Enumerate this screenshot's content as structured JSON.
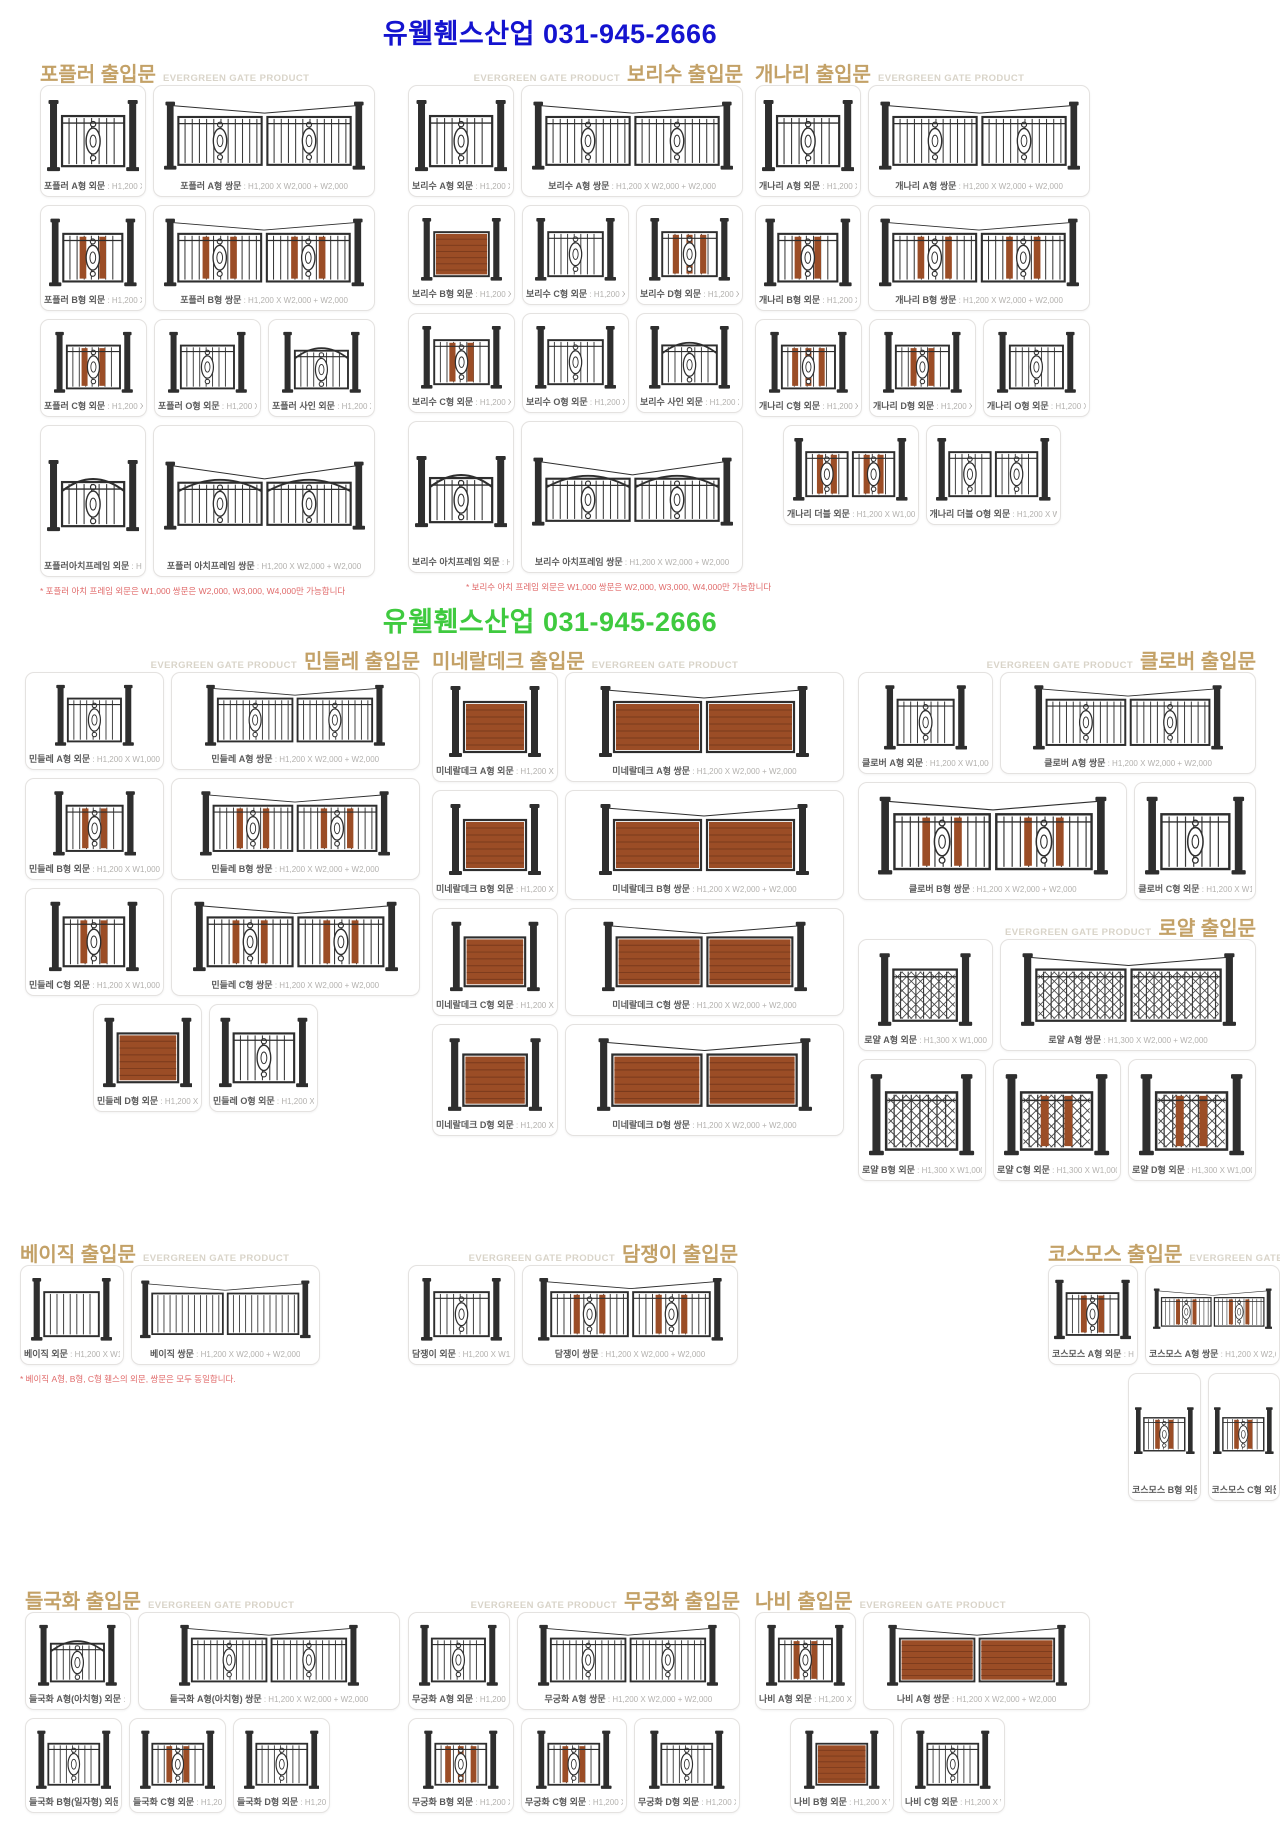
{
  "banners": {
    "top": {
      "text": "유웰휀스산업 031-945-2666",
      "color": "#1413cf"
    },
    "middle": {
      "text": "유웰휀스산업 031-945-2666",
      "color": "#3fca3f"
    }
  },
  "brand_tag": "EVERGREEN GATE PRODUCT",
  "colors": {
    "accent": "#c3a167",
    "egp_tag": "#d9d4c9",
    "wood": "#9b4d26",
    "iron": "#2e2e2e",
    "footnote": "#e06a6a"
  },
  "sections": [
    {
      "id": "poplar",
      "title": "포플러 출입문",
      "rows": [
        [
          {
            "label": "포플러 A형 외문",
            "size": "H1,200 X W1,000",
            "gate": {
              "l": 1
            }
          },
          {
            "label": "포플러 A형 쌍문",
            "size": "H1,200 X W2,000 + W2,000",
            "gate": {
              "l": 2,
              "cable": true
            }
          }
        ],
        [
          {
            "label": "포플러 B형 외문",
            "size": "H1,200 X W1,000",
            "gate": {
              "l": 1,
              "wood": 2
            }
          },
          {
            "label": "포플러 B형 쌍문",
            "size": "H1,200 X W2,000 + W2,000",
            "gate": {
              "l": 2,
              "wood": 2,
              "cable": true
            }
          }
        ],
        [
          {
            "label": "포플러 C형 외문",
            "size": "H1,200 X W1,000",
            "gate": {
              "l": 1,
              "wood": 2
            }
          },
          {
            "label": "포플러 O형 외문",
            "size": "H1,200 X W1,000",
            "gate": {
              "l": 1
            }
          },
          {
            "label": "포플러 사인 외문",
            "size": "H1,200 X W1,000",
            "gate": {
              "l": 1,
              "arch": true
            }
          }
        ],
        [
          {
            "label": "포플러아치프레임 외문",
            "size": "H1,200 X W1,000",
            "gate": {
              "l": 1,
              "arch": true
            }
          },
          {
            "label": "포플러 아치프레임 쌍문",
            "size": "H1,200 X W2,000 + W2,000",
            "gate": {
              "l": 2,
              "arch": true,
              "cable": true
            }
          }
        ]
      ],
      "footnote": "* 포플러 아치 프레임 외문은 W1,000 쌍문은 W2,000, W3,000, W4,000만 가능합니다"
    },
    {
      "id": "bodhi",
      "title": "보리수 출입문",
      "rows": [
        [
          {
            "label": "보리수 A형 외문",
            "size": "H1,200 X W1,000",
            "gate": {
              "l": 1
            }
          },
          {
            "label": "보리수 A형 쌍문",
            "size": "H1,200 X W2,000 + W2,000",
            "gate": {
              "l": 2,
              "cable": true
            }
          }
        ],
        [
          {
            "label": "보리수 B형 외문",
            "size": "H1,200 X W1,000",
            "gate": {
              "l": 1,
              "deck": true
            }
          },
          {
            "label": "보리수 C형 외문",
            "size": "H1,200 X W1,000",
            "gate": {
              "l": 1
            }
          },
          {
            "label": "보리수 D형 외문",
            "size": "H1,200 X W1,000",
            "gate": {
              "l": 1,
              "wood": 3
            }
          }
        ],
        [
          {
            "label": "보리수 C형 외문",
            "size": "H1,200 X W1,000",
            "gate": {
              "l": 1,
              "wood": 2
            }
          },
          {
            "label": "보리수 O형 외문",
            "size": "H1,200 X W1,000",
            "gate": {
              "l": 1
            }
          },
          {
            "label": "보리수 사인 외문",
            "size": "H1,200 X W1,000",
            "gate": {
              "l": 1,
              "arch": true
            }
          }
        ],
        [
          {
            "label": "보리수 아치프레임 외문",
            "size": "H1,200 X W1,000",
            "gate": {
              "l": 1,
              "arch": true
            }
          },
          {
            "label": "보리수 아치프레임 쌍문",
            "size": "H1,200 X W2,000 + W2,000",
            "gate": {
              "l": 2,
              "arch": true,
              "cable": true
            }
          }
        ]
      ],
      "footnote": "* 보리수 아치 프레임 외문은 W1,000 쌍문은 W2,000, W3,000, W4,000만 가능합니다"
    },
    {
      "id": "gaenari",
      "title": "개나리 출입문",
      "rows": [
        [
          {
            "label": "개나리 A형 외문",
            "size": "H1,200 X W1,000",
            "gate": {
              "l": 1
            }
          },
          {
            "label": "개나리 A형 쌍문",
            "size": "H1,200 X W2,000 + W2,000",
            "gate": {
              "l": 2,
              "cable": true
            }
          }
        ],
        [
          {
            "label": "개나리 B형 외문",
            "size": "H1,200 X W1,000",
            "gate": {
              "l": 1,
              "wood": 2
            }
          },
          {
            "label": "개나리 B형 쌍문",
            "size": "H1,200 X W2,000 + W2,000",
            "gate": {
              "l": 2,
              "wood": 2,
              "cable": true
            }
          }
        ],
        [
          {
            "label": "개나리 C형 외문",
            "size": "H1,200 X W1,000",
            "gate": {
              "l": 1,
              "wood": 3
            }
          },
          {
            "label": "개나리 D형 외문",
            "size": "H1,200 X W1,000",
            "gate": {
              "l": 1,
              "wood": 2
            }
          },
          {
            "label": "개나리 O형 외문",
            "size": "H1,200 X W1,000",
            "gate": {
              "l": 1
            }
          }
        ],
        [
          {
            "label": "개나리 더블 외문",
            "size": "H1,200 X W1,000",
            "gate": {
              "l": 2,
              "m": true,
              "wood": 2
            }
          },
          {
            "label": "개나리 더블 O형 외문",
            "size": "H1,200 X W1,000",
            "gate": {
              "l": 2,
              "m": true
            }
          }
        ]
      ]
    },
    {
      "id": "mindle",
      "title": "민들레 출입문",
      "rows": [
        [
          {
            "label": "민들레 A형 외문",
            "size": "H1,200 X W1,000",
            "gate": {
              "l": 1
            }
          },
          {
            "label": "민들레 A형 쌍문",
            "size": "H1,200 X W2,000 + W2,000",
            "gate": {
              "l": 2,
              "cable": true
            }
          }
        ],
        [
          {
            "label": "민들레 B형 외문",
            "size": "H1,200 X W1,000",
            "gate": {
              "l": 1,
              "wood": 2
            }
          },
          {
            "label": "민들레 B형 쌍문",
            "size": "H1,200 X W2,000 + W2,000",
            "gate": {
              "l": 2,
              "wood": 2,
              "cable": true
            }
          }
        ],
        [
          {
            "label": "민들레 C형 외문",
            "size": "H1,200 X W1,000",
            "gate": {
              "l": 1,
              "wood": 2
            }
          },
          {
            "label": "민들레 C형 쌍문",
            "size": "H1,200 X W2,000 + W2,000",
            "gate": {
              "l": 2,
              "wood": 2,
              "cable": true
            }
          }
        ],
        [
          {
            "label": "민들레 D형 외문",
            "size": "H1,200 X W1,000",
            "gate": {
              "l": 1,
              "deck": true
            }
          },
          {
            "label": "민들레 O형 외문",
            "size": "H1,200 X W1,000",
            "gate": {
              "l": 1
            }
          }
        ]
      ]
    },
    {
      "id": "mineral",
      "title": "미네랄데크 출입문",
      "rows": [
        [
          {
            "label": "미네랄데크 A형 외문",
            "size": "H1,200 X W1,000",
            "gate": {
              "l": 1,
              "deck": true
            }
          },
          {
            "label": "미네랄데크 A형 쌍문",
            "size": "H1,200 X W2,000 + W2,000",
            "gate": {
              "l": 2,
              "deck": true,
              "cable": true
            }
          }
        ],
        [
          {
            "label": "미네랄데크 B형 외문",
            "size": "H1,200 X W1,000",
            "gate": {
              "l": 1,
              "deck": true
            }
          },
          {
            "label": "미네랄데크 B형 쌍문",
            "size": "H1,200 X W2,000 + W2,000",
            "gate": {
              "l": 2,
              "deck": true,
              "cable": true
            }
          }
        ],
        [
          {
            "label": "미네랄데크 C형 외문",
            "size": "H1,200 X W1,000",
            "gate": {
              "l": 1,
              "deck": true
            }
          },
          {
            "label": "미네랄데크 C형 쌍문",
            "size": "H1,200 X W2,000 + W2,000",
            "gate": {
              "l": 2,
              "deck": true,
              "cable": true
            }
          }
        ],
        [
          {
            "label": "미네랄데크 D형 외문",
            "size": "H1,200 X W1,000",
            "gate": {
              "l": 1,
              "deck": true
            }
          },
          {
            "label": "미네랄데크 D형 쌍문",
            "size": "H1,200 X W2,000 + W2,000",
            "gate": {
              "l": 2,
              "deck": true,
              "cable": true
            }
          }
        ]
      ]
    },
    {
      "id": "clover",
      "title": "클로버 출입문",
      "rows": [
        [
          {
            "label": "클로버 A형 외문",
            "size": "H1,200 X W1,000",
            "gate": {
              "l": 1
            }
          },
          {
            "label": "클로버 A형 쌍문",
            "size": "H1,200 X W2,000 + W2,000",
            "gate": {
              "l": 2,
              "cable": true
            }
          }
        ],
        [
          {
            "label": "클로버 B형 쌍문",
            "size": "H1,200 X W2,000 + W2,000",
            "gate": {
              "l": 2,
              "wood": 2,
              "cable": true
            }
          },
          {
            "label": "클로버 C형 외문",
            "size": "H1,200 X W1,000",
            "gate": {
              "l": 1
            }
          }
        ]
      ]
    },
    {
      "id": "royal",
      "title": "로얄 출입문",
      "rows": [
        [
          {
            "label": "로얄 A형 외문",
            "size": "H1,300 X W1,000",
            "gate": {
              "l": 1,
              "lat": true
            }
          },
          {
            "label": "로얄 A형 쌍문",
            "size": "H1,300 X W2,000 + W2,000",
            "gate": {
              "l": 2,
              "lat": true,
              "cable": true
            }
          }
        ],
        [
          {
            "label": "로얄 B형 외문",
            "size": "H1,300 X W1,000",
            "gate": {
              "l": 1,
              "lat": true
            }
          },
          {
            "label": "로얄 C형 외문",
            "size": "H1,300 X W1,000",
            "gate": {
              "l": 1,
              "lat": true,
              "wood": 2
            }
          },
          {
            "label": "로얄 D형 외문",
            "size": "H1,300 X W1,000",
            "gate": {
              "l": 1,
              "lat": true,
              "wood": 2
            }
          }
        ]
      ]
    },
    {
      "id": "basic",
      "title": "베이직 출입문",
      "rows": [
        [
          {
            "label": "베이직 외문",
            "size": "H1,200 X W1,000",
            "gate": {
              "l": 1,
              "orn": false
            }
          },
          {
            "label": "베이직 쌍문",
            "size": "H1,200 X W2,000 + W2,000",
            "gate": {
              "l": 2,
              "orn": false,
              "cable": true
            }
          }
        ]
      ],
      "footnote": "* 베이직 A형, B형, C형 휀스의 외문, 쌍문은 모두 동일합니다."
    },
    {
      "id": "ivy",
      "title": "담쟁이 출입문",
      "rows": [
        [
          {
            "label": "담쟁이 외문",
            "size": "H1,200 X W1,000",
            "gate": {
              "l": 1
            }
          },
          {
            "label": "담쟁이 쌍문",
            "size": "H1,200 X W2,000 + W2,000",
            "gate": {
              "l": 2,
              "wood": 2,
              "cable": true
            }
          }
        ]
      ]
    },
    {
      "id": "cosmos",
      "title": "코스모스 출입문",
      "rows": [
        [
          {
            "label": "코스모스 A형 외문",
            "size": "H1,200 X W1,000",
            "gate": {
              "l": 1,
              "wood": 2
            }
          },
          {
            "label": "코스모스 A형 쌍문",
            "size": "H1,200 X W2,000 + W2,000",
            "gate": {
              "l": 2,
              "wood": 2,
              "cable": true
            }
          }
        ],
        [
          {
            "label": "코스모스 B형 외문",
            "size": "H1,200 X W1,000",
            "gate": {
              "l": 1,
              "wood": 2
            }
          },
          {
            "label": "코스모스 C형 외문",
            "size": "H1,200 X W1,000",
            "gate": {
              "l": 1,
              "wood": 2
            }
          }
        ]
      ]
    },
    {
      "id": "daisy",
      "title": "들국화 출입문",
      "rows": [
        [
          {
            "label": "들국화 A형(아치형) 외문",
            "size": "H1,200 X W1,000",
            "gate": {
              "l": 1,
              "arch": true
            }
          },
          {
            "label": "들국화 A형(아치형) 쌍문",
            "size": "H1,200 X W2,000 + W2,000",
            "gate": {
              "l": 2,
              "cable": true
            }
          }
        ],
        [
          {
            "label": "들국화 B형(일자형) 외문",
            "size": "H1,200 X W1,000",
            "gate": {
              "l": 1
            }
          },
          {
            "label": "들국화 C형 외문",
            "size": "H1,200 X W1,000",
            "gate": {
              "l": 1,
              "wood": 2
            }
          },
          {
            "label": "들국화 D형 외문",
            "size": "H1,200 X W1,000",
            "gate": {
              "l": 1
            }
          }
        ]
      ]
    },
    {
      "id": "rose",
      "title": "무궁화 출입문",
      "rows": [
        [
          {
            "label": "무궁화 A형 외문",
            "size": "H1,200 X W1,000",
            "gate": {
              "l": 1
            }
          },
          {
            "label": "무궁화 A형 쌍문",
            "size": "H1,200 X W2,000 + W2,000",
            "gate": {
              "l": 2,
              "cable": true
            }
          }
        ],
        [
          {
            "label": "무궁화 B형 외문",
            "size": "H1,200 X W1,000",
            "gate": {
              "l": 1,
              "wood": 3
            }
          },
          {
            "label": "무궁화 C형 외문",
            "size": "H1,200 X W1,000",
            "gate": {
              "l": 1,
              "wood": 2
            }
          },
          {
            "label": "무궁화 D형 외문",
            "size": "H1,200 X W1,000",
            "gate": {
              "l": 1
            }
          }
        ]
      ]
    },
    {
      "id": "butterfly",
      "title": "나비 출입문",
      "rows": [
        [
          {
            "label": "나비 A형 외문",
            "size": "H1,200 X W1,000",
            "gate": {
              "l": 1,
              "wood": 2
            }
          },
          {
            "label": "나비 A형 쌍문",
            "size": "H1,200 X W2,000 + W2,000",
            "gate": {
              "l": 2,
              "deck": true,
              "cable": true
            }
          }
        ],
        [
          {
            "label": "나비 B형 외문",
            "size": "H1,200 X W1,000",
            "gate": {
              "l": 1,
              "deck": true
            }
          },
          {
            "label": "나비 C형 외문",
            "size": "H1,200 X W1,000",
            "gate": {
              "l": 1
            }
          }
        ]
      ]
    }
  ]
}
